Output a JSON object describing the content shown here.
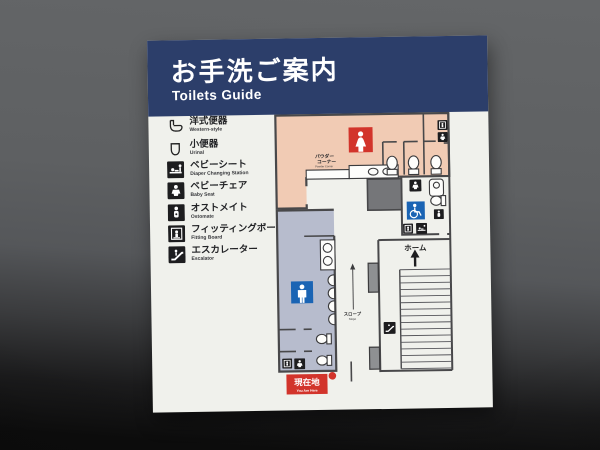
{
  "sign": {
    "header": {
      "title_jp": "お手洗ご案内",
      "title_en": "Toilets Guide"
    },
    "legend": {
      "items": [
        {
          "jp": "洋式便器",
          "en": "Western-style",
          "icon": "western-toilet-icon"
        },
        {
          "jp": "小便器",
          "en": "Urinal",
          "icon": "urinal-icon"
        },
        {
          "jp": "ベビーシート",
          "en": "Diaper Changing Station",
          "icon": "diaper-changing-station-icon"
        },
        {
          "jp": "ベビーチェア",
          "en": "Baby Seat",
          "icon": "baby-seat-icon"
        },
        {
          "jp": "オストメイト",
          "en": "Ostomate",
          "icon": "ostomate-icon"
        },
        {
          "jp": "フィッティングボード",
          "en": "Fitting Board",
          "icon": "fitting-board-icon"
        },
        {
          "jp": "エスカレーター",
          "en": "Escalator",
          "icon": "escalator-icon"
        }
      ]
    },
    "map": {
      "labels": {
        "powder_corner_line1": "パウダー",
        "powder_corner_line2": "コーナー",
        "powder_corner_en": "Powder Corner",
        "platform": "ホーム",
        "slope_jp": "スロープ",
        "slope_en": "Slope",
        "you_are_here_jp": "現在地",
        "you_are_here_en": "You Are Here"
      },
      "pictograms": [
        "womens-toilet-icon",
        "mens-toilet-icon",
        "wheelchair-accessible-icon",
        "baby-seat-icon",
        "ostomate-icon",
        "fitting-board-icon",
        "diaper-changing-station-icon",
        "escalator-icon",
        "western-toilet-icon",
        "urinal-icon",
        "sink-icon"
      ],
      "colors": {
        "womens_area": "#f1cbb4",
        "mens_area": "#b7bccd",
        "womens_pictogram_bg": "#d2342b",
        "mens_pictogram_bg": "#1a64b4",
        "accessible_pictogram_bg": "#1a64b4",
        "you_are_here_bg": "#d2342b",
        "wall": "#48484a"
      }
    },
    "colors": {
      "header_bg": "#2c3e6a",
      "header_text": "#ffffff",
      "sign_bg": "#f0f1ec"
    }
  }
}
